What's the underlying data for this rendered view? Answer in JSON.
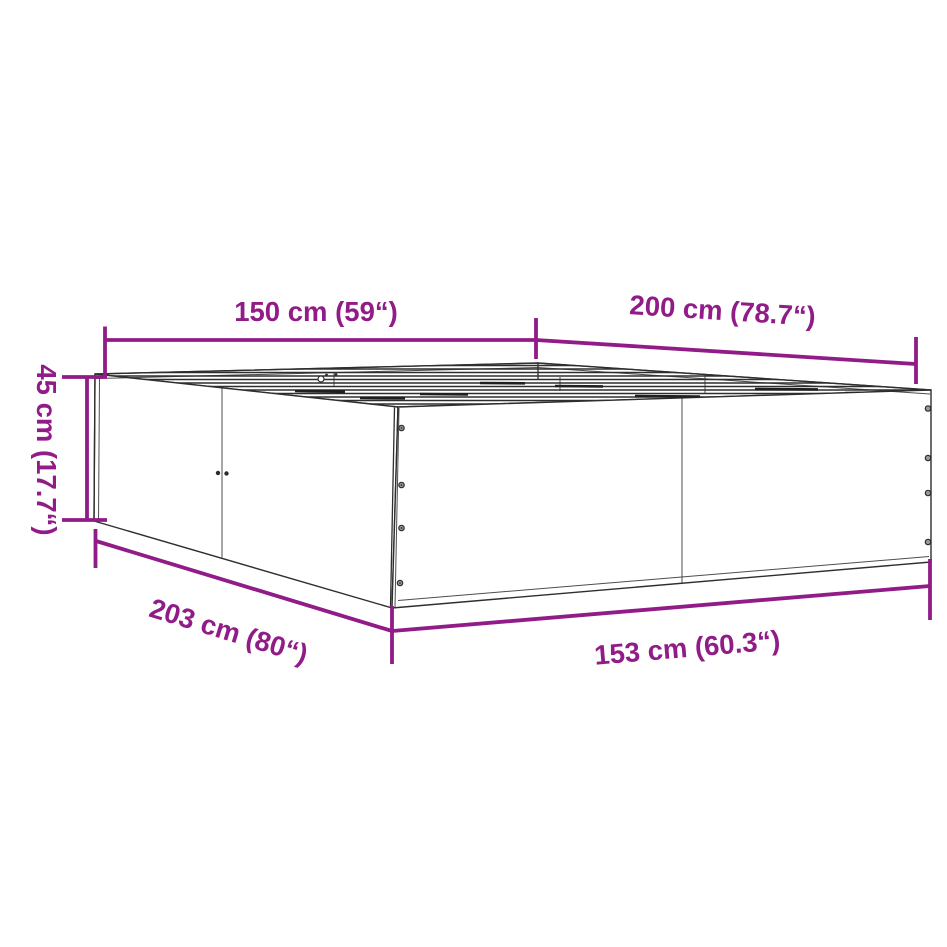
{
  "diagram": {
    "type": "product-dimension-diagram",
    "subject": "bed-frame-with-slatted-base",
    "colors": {
      "accent": "#911C88",
      "line": "#2E2E2E",
      "background": "#FFFFFF"
    },
    "dimensions": {
      "top_width": "150 cm (59“)",
      "top_length": "200 cm (78.7“)",
      "height": "45 cm (17.7“)",
      "bottom_length": "203 cm (80“)",
      "bottom_width": "153 cm (60.3“)"
    }
  }
}
